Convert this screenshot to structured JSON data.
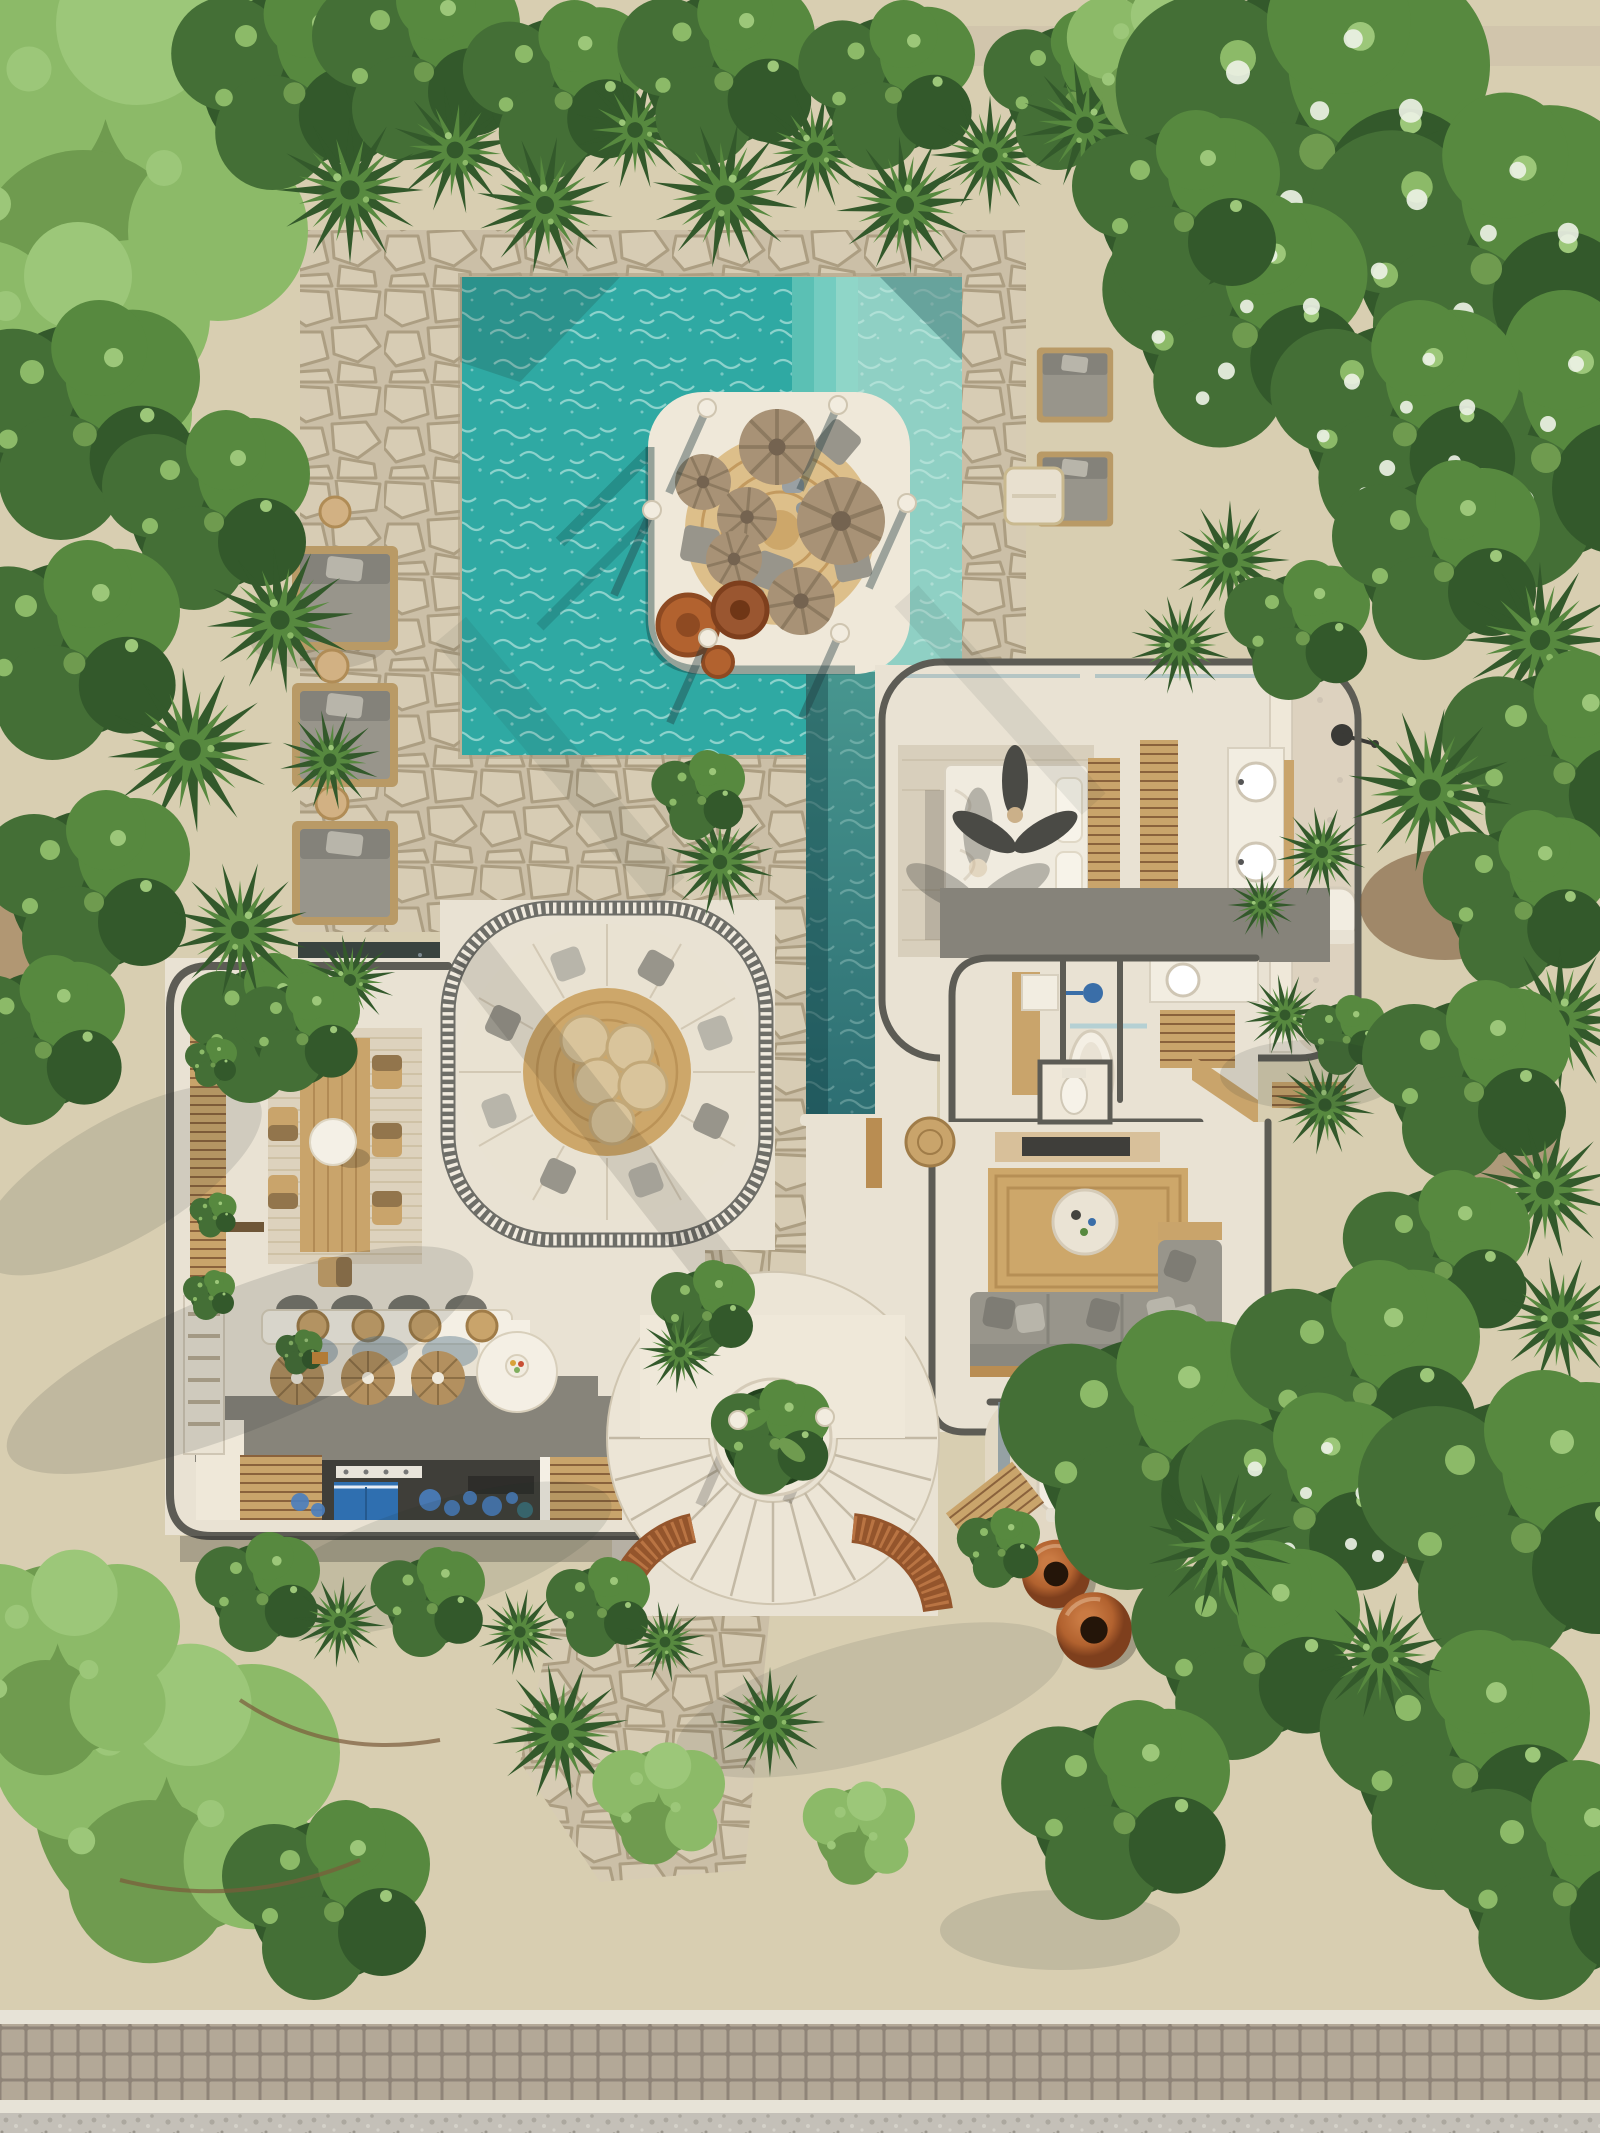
{
  "scene": {
    "title": "Aerial Villa Render",
    "description": "Top-down architectural rendering of a tropical villa: turquoise swimming pool with sun deck island and parasol cushions, lap-pool water channel, open-roof villa interior with bedroom, bathrooms, sunken circular lounge, dining terrace, bar and kitchen, spiral staircase with central planter, surrounded by dense palm and tree canopy, sandy ground and a cobble-paved road at the bottom",
    "regions": [
      {
        "name": "swimming-pool",
        "label": "Swimming pool with steps and shallow shelf"
      },
      {
        "name": "sun-deck-island",
        "label": "Round-cornered pool island with jute rug, palm-leaf parasol cushions and terracotta pots"
      },
      {
        "name": "lap-channel",
        "label": "Narrow lap-pool water channel running south"
      },
      {
        "name": "sun-loungers-west",
        "label": "Three double sun loungers on flagstone"
      },
      {
        "name": "daybeds-northeast",
        "label": "Two garden daybeds under flowering tree"
      },
      {
        "name": "bedroom",
        "label": "Bedroom with bed, ceiling fan and double vanity"
      },
      {
        "name": "ensuite-bathroom",
        "label": "Open-air bathroom with shower, toilet and palms"
      },
      {
        "name": "bathtub-room",
        "label": "Interior bathroom with freestanding tub"
      },
      {
        "name": "living-room",
        "label": "Living room with jute rug, round coffee table and L-shaped sofa"
      },
      {
        "name": "sunken-lounge",
        "label": "Circular sunken lounge with louvred pergola ring and pouf cluster"
      },
      {
        "name": "dining-terrace",
        "label": "Dining terrace with long wooden table and sphere pendant"
      },
      {
        "name": "bar-kitchen",
        "label": "Bar counter with stools, rattan pendants and blue kitchen cabinet"
      },
      {
        "name": "spiral-staircase",
        "label": "Fan-shaped spiral staircase around circular planter"
      },
      {
        "name": "powder-courtyard",
        "label": "Outdoor powder room with arched toilet niche and urns"
      },
      {
        "name": "garden",
        "label": "Tropical garden: palms, bushes, flowering canopy, sandy ground"
      },
      {
        "name": "road",
        "label": "Cobblestone paver road with white curbs and gravel verge"
      }
    ],
    "counts": {
      "sun_loungers_west": 3,
      "daybeds_northeast": 2,
      "pool_side_tables": 3,
      "island_pergola_posts": 6,
      "parasol_floor_cushions": 6,
      "island_terracotta_pots": 3,
      "dining_chairs": 8,
      "dining_sphere_lamps": 1,
      "bar_stools": 4,
      "rattan_pendant_lamps": 3,
      "lounge_center_poufs": 5,
      "spiral_stair_steps": 13,
      "garden_urns": 2,
      "ceiling_fan_blades": 3,
      "vanity_sinks": 2,
      "toilets": 2,
      "bathtubs": 1
    }
  },
  "palette": {
    "sand": "#d5c9ab",
    "sand-2": "#e0d6bc",
    "sand-shadow": "#b7a888",
    "flag": "#cbbfa7",
    "flag-stone": "#d7ccb4",
    "flag-line": "#ac9e82",
    "deck": "#efe8d9",
    "deck-line": "#d2c8b2",
    "floor": "#e9e2d3",
    "floor-2": "#ddd3c0",
    "wall": "#5d5c55",
    "wood": "#c9a46b",
    "wood-2": "#b98d52",
    "wood-3": "#8a623c",
    "cream": "#e9e2d2",
    "white": "#f4efe4",
    "gray-1": "#98958b",
    "gray-2": "#7e7c73",
    "gray-3": "#b8b5aa",
    "jute": "#cda76a",
    "jute-2": "#ddbf8a",
    "pool-deep": "#2fa9a3",
    "pool-step": "#8fd6c8",
    "shallow": "#8fd0c4",
    "caustic": "#d8f4ec",
    "chan-1": "#47968f",
    "chan-2": "#2d6e72",
    "green-1": "#33592b",
    "green-2": "#446f36",
    "green-3": "#57893f",
    "green-4": "#6f9b4f",
    "green-5": "#8cba68",
    "green-6": "#9cc779",
    "terra-1": "#b2622f",
    "terra-2": "#7e3f1d",
    "blue": "#2f6fb0",
    "blue-2": "#4a7fc0",
    "road": "#b3a897",
    "road-line": "#8f8478",
    "curb": "#e7e3d7",
    "gravel": "#c9c5bc",
    "gravel-dot": "#a8a49b",
    "dirt": "#7c5a38",
    "shadow": "#1e2a28"
  }
}
